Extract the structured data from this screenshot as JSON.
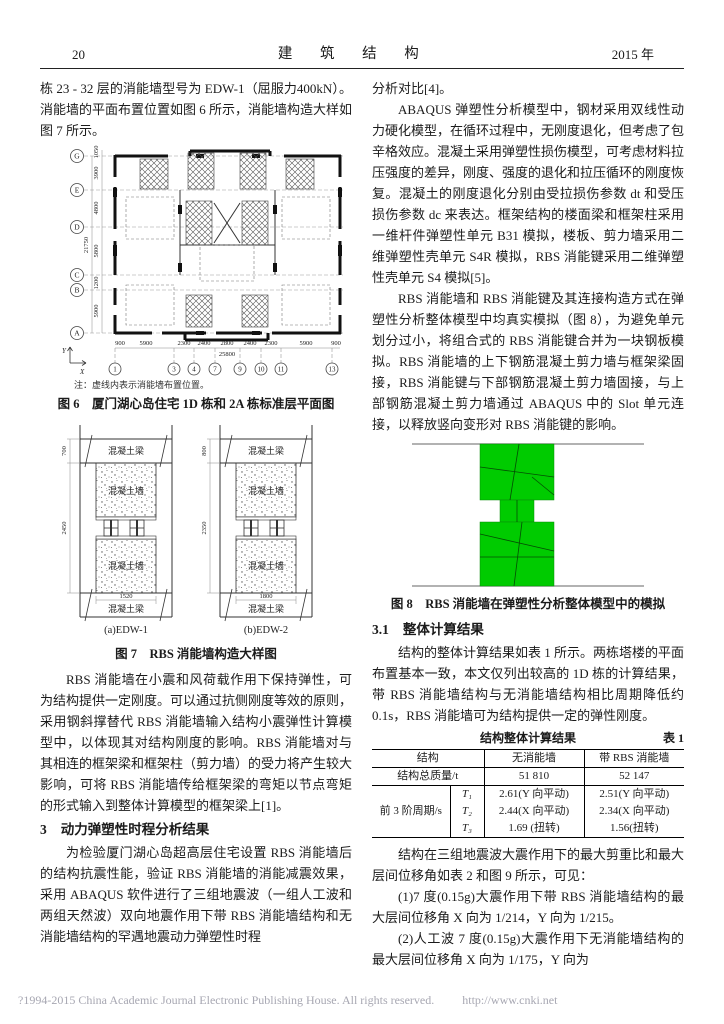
{
  "header": {
    "page_number": "20",
    "journal_title": "建 筑 结 构",
    "year": "2015 年"
  },
  "left": {
    "para_intro": "栋 23 - 32 层的消能墙型号为 EDW-1（屈服力400kN）。消能墙的平面布置位置如图 6 所示，消能墙构造大样如图 7 所示。",
    "figure6": {
      "row_labels": [
        "G",
        "E",
        "D",
        "C",
        "B",
        "A"
      ],
      "row_dims": [
        "1050",
        "3900",
        "4800",
        "5800",
        "1200",
        "5900"
      ],
      "total_height_dim": "21750",
      "col_dims": [
        "900",
        "5900",
        "2300",
        "2400",
        "2800",
        "2400",
        "2300",
        "5900",
        "900"
      ],
      "total_width_dim": "25800",
      "col_labels": [
        "1",
        "3",
        "4",
        "7",
        "9",
        "10",
        "11",
        "13"
      ],
      "axis_x_label": "X",
      "axis_y_label": "Y",
      "note": "注：虚线内表示消能墙布置位置。",
      "caption": "图 6　厦门湖心岛住宅 1D 栋和 2A 栋标准层平面图"
    },
    "figure7": {
      "caption": "图 7　RBS 消能墙构造大样图",
      "details": [
        {
          "label": "(a)EDW-1",
          "dim_beam": "700",
          "dim_wall": "2450",
          "dim_width": "1520",
          "beam_top": "混凝土梁",
          "wall_top": "混凝土墙",
          "wall_bottom": "混凝土墙",
          "beam_bottom": "混凝土梁"
        },
        {
          "label": "(b)EDW-2",
          "dim_beam": "800",
          "dim_wall": "2350",
          "dim_width": "1800",
          "beam_top": "混凝土梁",
          "wall_top": "混凝土墙",
          "wall_bottom": "混凝土墙",
          "beam_bottom": "混凝土梁"
        }
      ]
    },
    "para_rbs": "RBS 消能墙在小震和风荷载作用下保持弹性，可为结构提供一定刚度。可以通过抗侧刚度等效的原则，采用钢斜撑替代 RBS 消能墙输入结构小震弹性计算模型中，以体现其对结构刚度的影响。RBS 消能墙对与其相连的框架梁和框架柱（剪力墙）的受力将产生较大影响，可将 RBS 消能墙传给框架梁的弯矩以节点弯矩的形式输入到整体计算模型的框架梁上[1]。",
    "section3_number": "3",
    "section3_title": "动力弹塑性时程分析结果",
    "para_section3": "为检验厦门湖心岛超高层住宅设置 RBS 消能墙后的结构抗震性能，验证 RBS 消能墙的消能减震效果，采用 ABAQUS 软件进行了三组地震波（一组人工波和两组天然波）双向地震作用下带 RBS 消能墙结构和无消能墙结构的罕遇地震动力弹塑性时程"
  },
  "right": {
    "para_continuation": "分析对比[4]。",
    "para_abaqus": "ABAQUS 弹塑性分析模型中，钢材采用双线性动力硬化模型，在循环过程中，无刚度退化，但考虑了包辛格效应。混凝土采用弹塑性损伤模型，可考虑材料拉压强度的差异，刚度、强度的退化和拉压循环的刚度恢复。混凝土的刚度退化分别由受拉损伤参数 dt 和受压损伤参数 dc 来表达。框架结构的楼面梁和框架柱采用一维杆件弹塑性单元 B31 模拟，楼板、剪力墙采用二维弹塑性壳单元 S4R 模拟，RBS 消能键采用二维弹塑性壳单元 S4 模拟[5]。",
    "para_model": "RBS 消能墙和 RBS 消能键及其连接构造方式在弹塑性分析整体模型中均真实模拟（图 8），为避免单元划分过小，将组合式的 RBS 消能键合并为一块钢板模拟。RBS 消能墙的上下钢筋混凝土剪力墙与框架梁固接，RBS 消能键与下部钢筋混凝土剪力墙固接，与上部钢筋混凝土剪力墙通过 ABAQUS 中的 Slot 单元连接，以释放竖向变形对 RBS 消能键的影响。",
    "figure8": {
      "caption": "图 8　RBS 消能墙在弹塑性分析整体模型中的模拟",
      "green_color": "#00cb00"
    },
    "section31_number": "3.1",
    "section31_title": "整体计算结果",
    "para_results": "结构的整体计算结果如表 1 所示。两栋塔楼的平面布置基本一致，本文仅列出较高的 1D 栋的计算结果，带 RBS 消能墙结构与无消能墙结构相比周期降低约 0.1s，RBS 消能墙可为结构提供一定的弹性刚度。",
    "table1": {
      "title": "结构整体计算结果",
      "label": "表 1",
      "col_headers": [
        "结构",
        "无消能墙",
        "带 RBS 消能墙"
      ],
      "mass_row": {
        "label": "结构总质量/t",
        "without": "51 810",
        "with": "52 147"
      },
      "period_group_label": "前 3 阶周期/s",
      "period_rows": [
        {
          "mode": "T₁",
          "without": "2.61(Y 向平动)",
          "with": "2.51(Y 向平动)"
        },
        {
          "mode": "T₂",
          "without": "2.44(X 向平动)",
          "with": "2.34(X 向平动)"
        },
        {
          "mode": "T₃",
          "without": "1.69 (扭转)",
          "with": "1.56(扭转)"
        }
      ]
    },
    "para_waves": "结构在三组地震波大震作用下的最大剪重比和最大层间位移角如表 2 和图 9 所示，可见：",
    "item1": "(1)7 度(0.15g)大震作用下带 RBS 消能墙结构的最大层间位移角 X 向为 1/214，Y 向为 1/215。",
    "item2": "(2)人工波 7 度(0.15g)大震作用下无消能墙结构的最大层间位移角 X 向为 1/175，Y 向为"
  },
  "footer": {
    "copyright": "?1994-2015 China Academic Journal Electronic Publishing House. All rights reserved.",
    "url": "http://www.cnki.net"
  }
}
